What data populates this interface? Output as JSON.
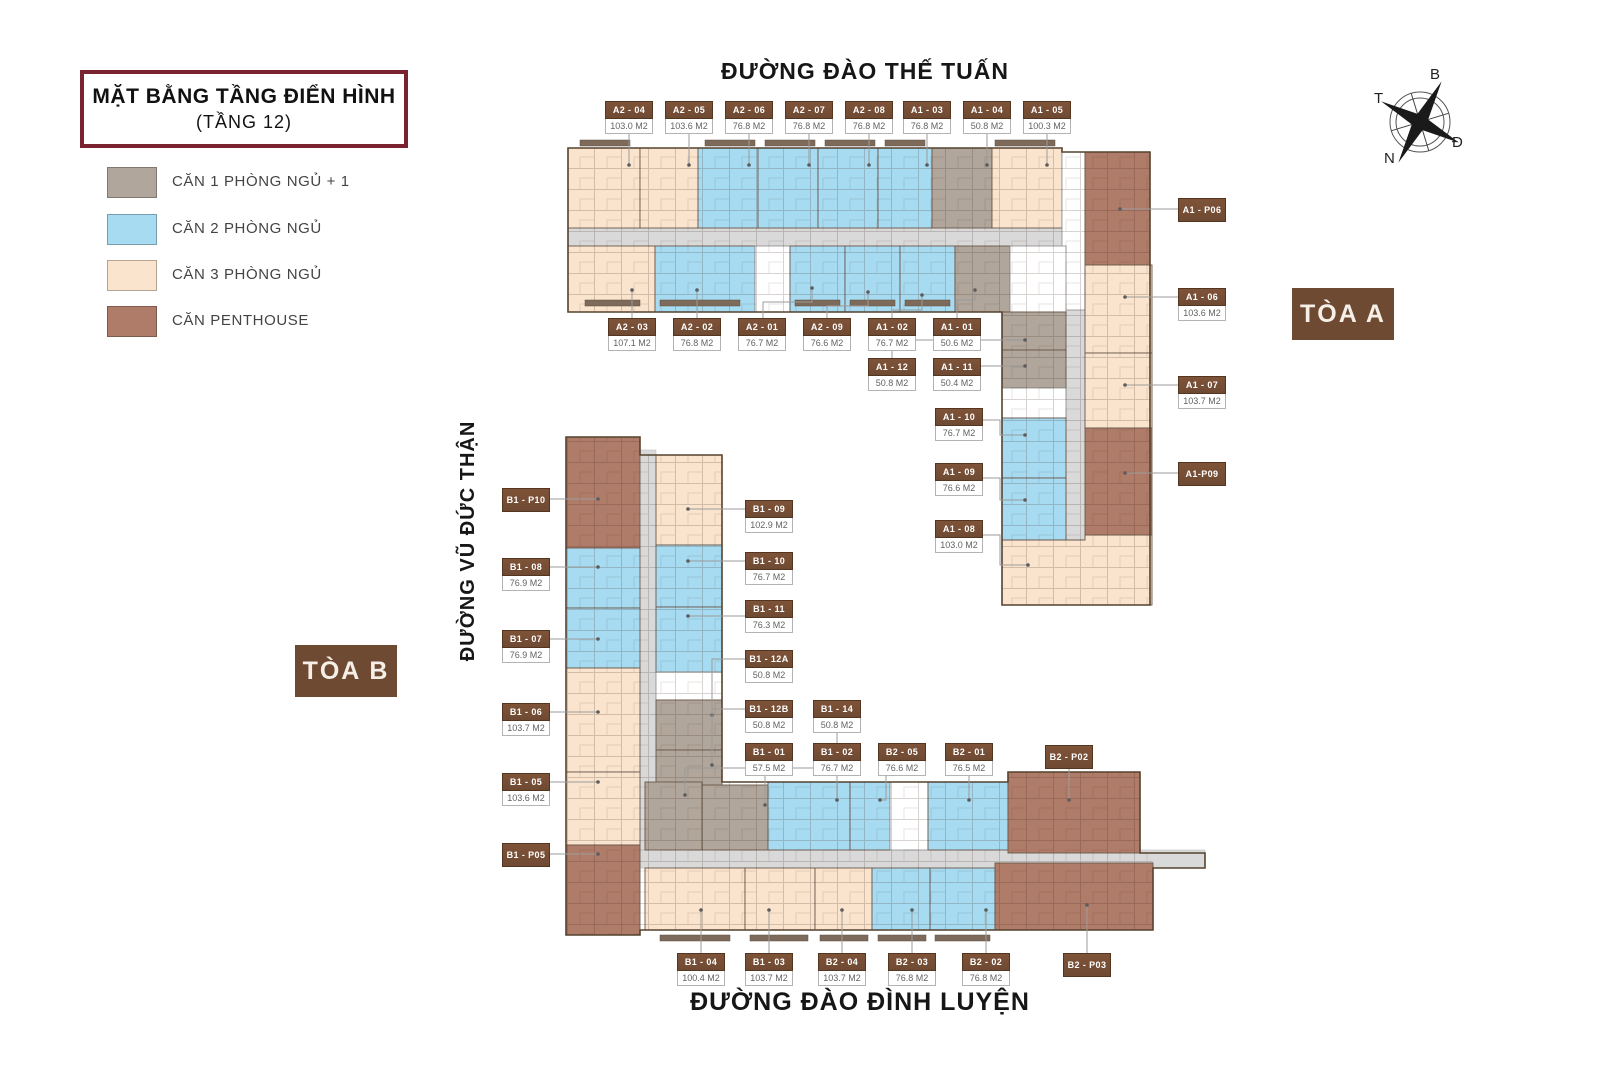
{
  "title": {
    "line1": "MẶT BẰNG TẦNG ĐIỂN HÌNH",
    "line2": "(TẦNG 12)"
  },
  "legend": {
    "items": [
      {
        "label": "CĂN 1 PHÒNG NGỦ + 1"
      },
      {
        "label": "CĂN 2 PHÒNG NGỦ"
      },
      {
        "label": "CĂN 3 PHÒNG NGỦ"
      },
      {
        "label": "CĂN PENTHOUSE"
      }
    ]
  },
  "streets": {
    "top": "ĐƯỜNG ĐÀO THẾ TUẤN",
    "left": "ĐƯỜNG VŨ ĐỨC THẬN",
    "bottom": "ĐƯỜNG ĐÀO ĐÌNH LUYỆN"
  },
  "towers": {
    "a": "TÒA A",
    "b": "TÒA B"
  },
  "compass": {
    "north": "B",
    "east": "Đ",
    "south": "N",
    "west": "T"
  },
  "colors": {
    "br1": "#b1a69b",
    "br2": "#a7dbf2",
    "br3": "#fae4cd",
    "ph": "#b07c6a",
    "chip": "#6f4a33",
    "corridor": "#d9d9d9",
    "title_border": "#7a2230"
  },
  "units": {
    "a2_04": {
      "code": "A2 - 04",
      "area": "103.0 M2",
      "type": "3br"
    },
    "a2_05": {
      "code": "A2 - 05",
      "area": "103.6 M2",
      "type": "3br"
    },
    "a2_06": {
      "code": "A2 - 06",
      "area": "76.8 M2",
      "type": "2br"
    },
    "a2_07": {
      "code": "A2 - 07",
      "area": "76.8 M2",
      "type": "2br"
    },
    "a2_08": {
      "code": "A2 - 08",
      "area": "76.8 M2",
      "type": "2br"
    },
    "a1_03": {
      "code": "A1 - 03",
      "area": "76.8 M2",
      "type": "2br"
    },
    "a1_04": {
      "code": "A1 - 04",
      "area": "50.8 M2",
      "type": "1br+1"
    },
    "a1_05": {
      "code": "A1 - 05",
      "area": "100.3 M2",
      "type": "3br"
    },
    "a2_03": {
      "code": "A2 - 03",
      "area": "107.1 M2",
      "type": "3br"
    },
    "a2_02": {
      "code": "A2 - 02",
      "area": "76.8 M2",
      "type": "2br"
    },
    "a2_01": {
      "code": "A2 - 01",
      "area": "76.7 M2",
      "type": "2br"
    },
    "a2_09": {
      "code": "A2 - 09",
      "area": "76.6 M2",
      "type": "2br"
    },
    "a1_02": {
      "code": "A1 - 02",
      "area": "76.7 M2",
      "type": "2br"
    },
    "a1_01": {
      "code": "A1 - 01",
      "area": "50.6 M2",
      "type": "1br+1"
    },
    "a1_12": {
      "code": "A1 - 12",
      "area": "50.8 M2",
      "type": "1br+1"
    },
    "a1_11": {
      "code": "A1 - 11",
      "area": "50.4 M2",
      "type": "1br+1"
    },
    "a1_10": {
      "code": "A1 - 10",
      "area": "76.7 M2",
      "type": "2br"
    },
    "a1_09": {
      "code": "A1 - 09",
      "area": "76.6 M2",
      "type": "2br"
    },
    "a1_08": {
      "code": "A1 - 08",
      "area": "103.0 M2",
      "type": "3br"
    },
    "a1_p06": {
      "code": "A1 - P06",
      "type": "penthouse"
    },
    "a1_06": {
      "code": "A1 - 06",
      "area": "103.6 M2",
      "type": "3br"
    },
    "a1_07": {
      "code": "A1 - 07",
      "area": "103.7 M2",
      "type": "3br"
    },
    "a1_p09": {
      "code": "A1-P09",
      "type": "penthouse"
    },
    "b1_p10": {
      "code": "B1 - P10",
      "type": "penthouse"
    },
    "b1_08": {
      "code": "B1 - 08",
      "area": "76.9 M2",
      "type": "2br"
    },
    "b1_07": {
      "code": "B1 - 07",
      "area": "76.9 M2",
      "type": "2br"
    },
    "b1_06": {
      "code": "B1 - 06",
      "area": "103.7 M2",
      "type": "3br"
    },
    "b1_05": {
      "code": "B1 - 05",
      "area": "103.6 M2",
      "type": "3br"
    },
    "b1_p05": {
      "code": "B1 - P05",
      "type": "penthouse"
    },
    "b1_09": {
      "code": "B1 - 09",
      "area": "102.9 M2",
      "type": "3br"
    },
    "b1_10": {
      "code": "B1 - 10",
      "area": "76.7 M2",
      "type": "2br"
    },
    "b1_11": {
      "code": "B1 - 11",
      "area": "76.3 M2",
      "type": "2br"
    },
    "b1_12a": {
      "code": "B1 - 12A",
      "area": "50.8 M2",
      "type": "1br+1"
    },
    "b1_12b": {
      "code": "B1 - 12B",
      "area": "50.8 M2",
      "type": "1br+1"
    },
    "b1_14": {
      "code": "B1 - 14",
      "area": "50.8 M2",
      "type": "1br+1"
    },
    "b1_01": {
      "code": "B1 - 01",
      "area": "57.5 M2",
      "type": "1br+1"
    },
    "b1_02": {
      "code": "B1 - 02",
      "area": "76.7 M2",
      "type": "2br"
    },
    "b2_05": {
      "code": "B2 - 05",
      "area": "76.6 M2",
      "type": "2br"
    },
    "b2_01": {
      "code": "B2 - 01",
      "area": "76.5 M2",
      "type": "2br"
    },
    "b2_p02": {
      "code": "B2 - P02",
      "type": "penthouse"
    },
    "b1_04": {
      "code": "B1 - 04",
      "area": "100.4 M2",
      "type": "3br"
    },
    "b1_03": {
      "code": "B1 - 03",
      "area": "103.7 M2",
      "type": "3br"
    },
    "b2_04": {
      "code": "B2 - 04",
      "area": "103.7 M2",
      "type": "3br"
    },
    "b2_03": {
      "code": "B2 - 03",
      "area": "76.8 M2",
      "type": "2br"
    },
    "b2_02": {
      "code": "B2 - 02",
      "area": "76.8 M2",
      "type": "2br"
    },
    "b2_p03": {
      "code": "B2 - P03",
      "type": "penthouse"
    }
  }
}
